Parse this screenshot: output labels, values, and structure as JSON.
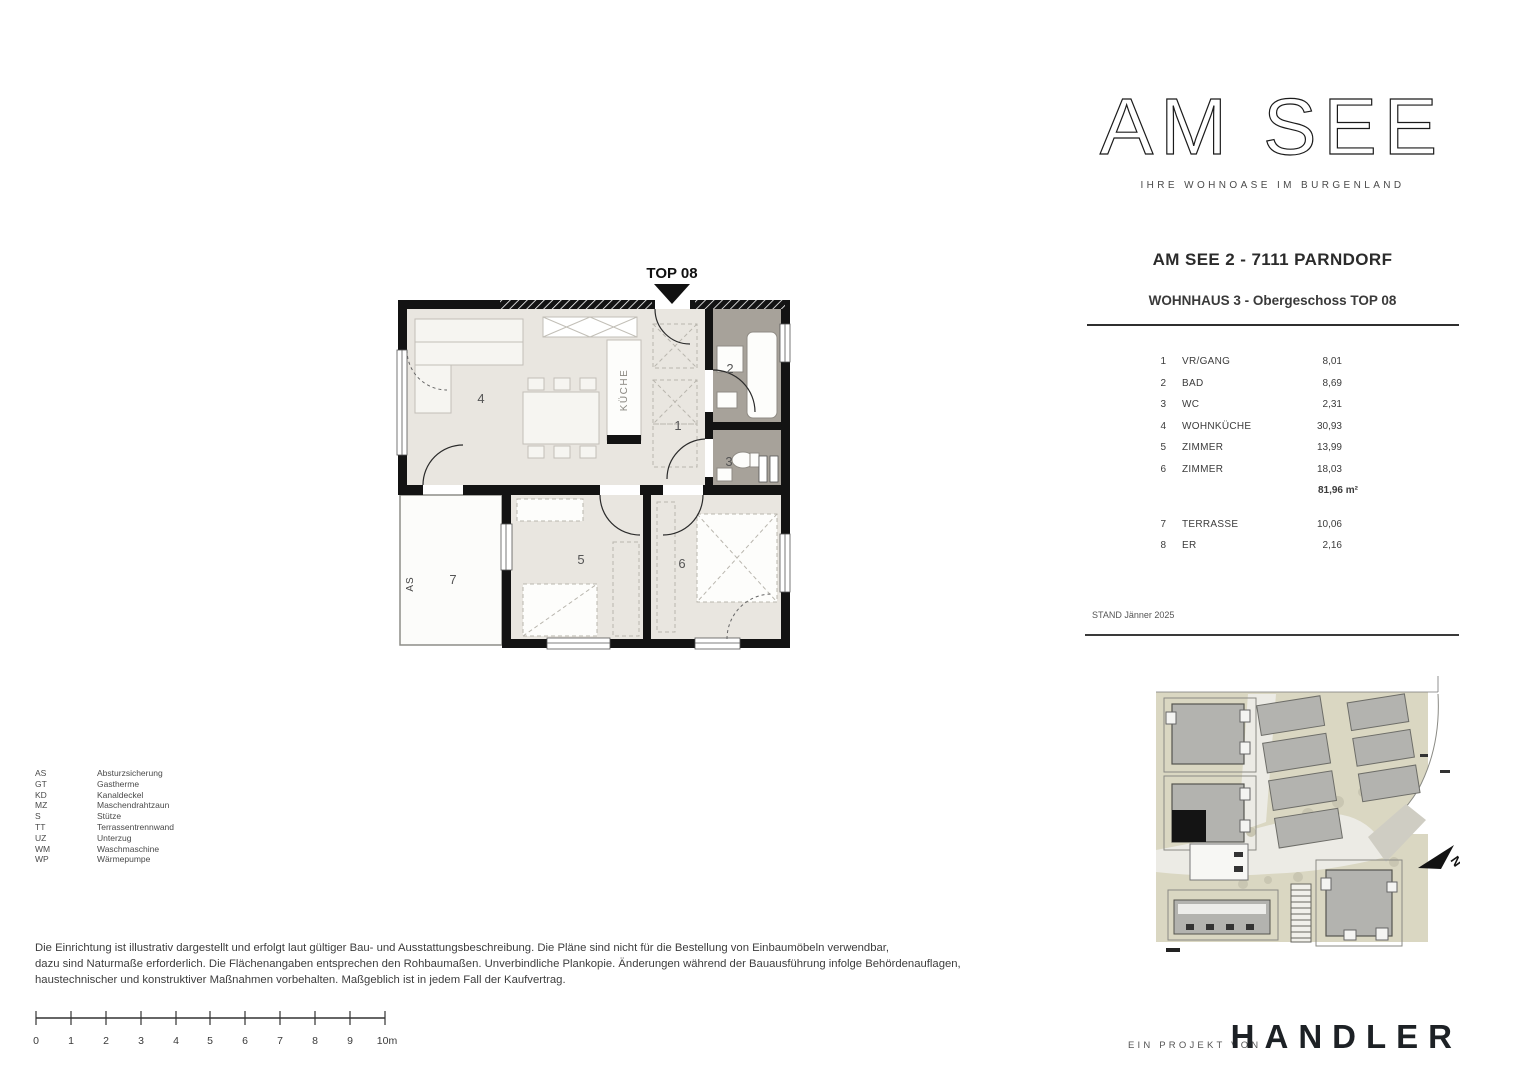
{
  "header": {
    "logo": "AM SEE",
    "tagline": "IHRE WOHNOASE IM BURGENLAND",
    "project_title": "AM SEE 2 - 7111 PARNDORF",
    "plan_subtitle": "WOHNHAUS 3 - Obergeschoss TOP 08"
  },
  "room_table": {
    "rows": [
      {
        "no": "1",
        "name": "VR/GANG",
        "area": "8,01"
      },
      {
        "no": "2",
        "name": "BAD",
        "area": "8,69"
      },
      {
        "no": "3",
        "name": "WC",
        "area": "2,31"
      },
      {
        "no": "4",
        "name": "WOHNKÜCHE",
        "area": "30,93"
      },
      {
        "no": "5",
        "name": "ZIMMER",
        "area": "13,99"
      },
      {
        "no": "6",
        "name": "ZIMMER",
        "area": "18,03"
      }
    ],
    "total": "81,96 m²",
    "extra_rows": [
      {
        "no": "7",
        "name": "TERRASSE",
        "area": "10,06"
      },
      {
        "no": "8",
        "name": "ER",
        "area": "2,16"
      }
    ]
  },
  "status": {
    "stand": "STAND Jänner 2025"
  },
  "floorplan": {
    "top_label": "TOP 08",
    "kitchen_label": "KÜCHE",
    "as_label": "AS",
    "numbers": [
      "1",
      "2",
      "3",
      "4",
      "5",
      "6",
      "7"
    ]
  },
  "site_plan": {
    "north_label": "N"
  },
  "abbr_legend": {
    "items": [
      {
        "abbr": "AS",
        "term": "Absturzsicherung"
      },
      {
        "abbr": "GT",
        "term": "Gastherme"
      },
      {
        "abbr": "KD",
        "term": "Kanaldeckel"
      },
      {
        "abbr": "MZ",
        "term": "Maschendrahtzaun"
      },
      {
        "abbr": "S",
        "term": "Stütze"
      },
      {
        "abbr": "TT",
        "term": "Terrassentrennwand"
      },
      {
        "abbr": "UZ",
        "term": "Unterzug"
      },
      {
        "abbr": "WM",
        "term": "Waschmaschine"
      },
      {
        "abbr": "WP",
        "term": "Wärmepumpe"
      }
    ]
  },
  "disclaimer": {
    "lines": [
      "Die Einrichtung ist illustrativ dargestellt und erfolgt laut gültiger Bau- und Ausstattungsbeschreibung. Die Pläne sind nicht für die Bestellung von Einbaumöbeln verwendbar,",
      "dazu sind Naturmaße erforderlich. Die Flächenangaben entsprechen den Rohbaumaßen. Unverbindliche Plankopie. Änderungen während der Bauausführung infolge Behördenauflagen,",
      "haustechnischer und konstruktiver Maßnahmen vorbehalten. Maßgeblich ist in jedem Fall der Kaufvertrag."
    ]
  },
  "scalebar": {
    "labels": [
      "0",
      "1",
      "2",
      "3",
      "4",
      "5",
      "6",
      "7",
      "8",
      "9",
      "10m"
    ]
  },
  "footer": {
    "prefix": "EIN PROJEKT VON",
    "brand": "HANDLER"
  },
  "colors": {
    "wall": "#131313",
    "room_floor": "#e9e6e0",
    "wet_room_floor": "#a7a29a",
    "furniture_stroke": "#c2bfb7",
    "site_parcel": "#dad7c2",
    "site_building": "#b3b3af",
    "highlight_unit": "#141414"
  }
}
